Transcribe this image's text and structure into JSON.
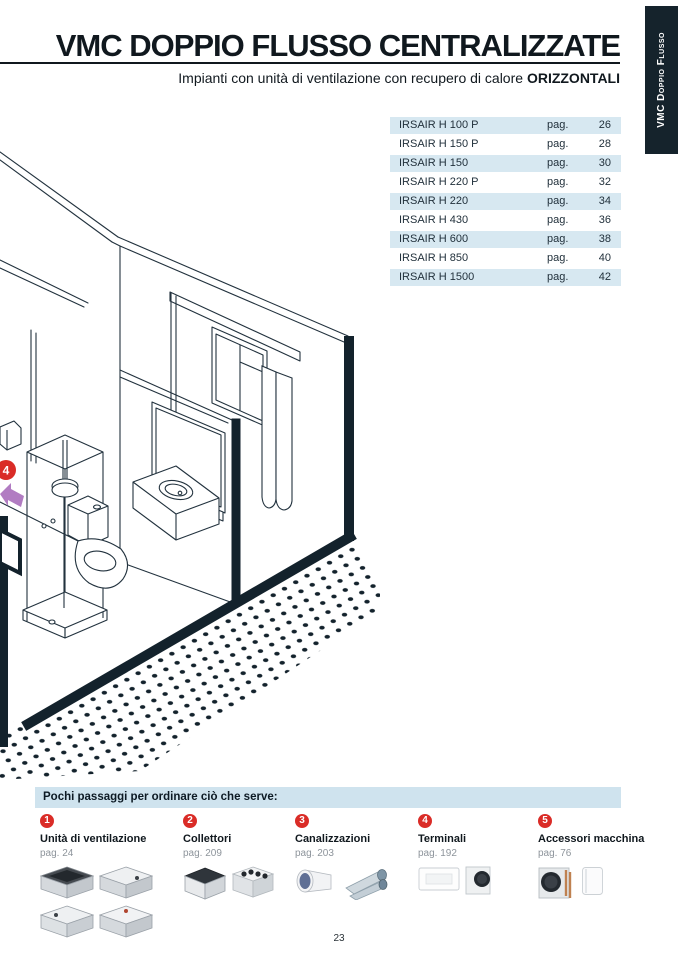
{
  "header": {
    "title": "VMC DOPPIO FLUSSO CENTRALIZZATE",
    "subtitle_prefix": "Impianti con unità di ventilazione con recupero di calore ",
    "subtitle_bold": "ORIZZONTALI",
    "side_tab_label": "VMC Doppio Flusso"
  },
  "products_table": {
    "pag_label": "pag.",
    "rows": [
      {
        "name": "IRSAIR H 100 P",
        "page": "26"
      },
      {
        "name": "IRSAIR H 150 P",
        "page": "28"
      },
      {
        "name": "IRSAIR H 150",
        "page": "30"
      },
      {
        "name": "IRSAIR H 220 P",
        "page": "32"
      },
      {
        "name": "IRSAIR H 220",
        "page": "34"
      },
      {
        "name": "IRSAIR H 430",
        "page": "36"
      },
      {
        "name": "IRSAIR H 600",
        "page": "38"
      },
      {
        "name": "IRSAIR H 850",
        "page": "40"
      },
      {
        "name": "IRSAIR H 1500",
        "page": "42"
      }
    ]
  },
  "diagram": {
    "callout_number": "4"
  },
  "steps": {
    "heading": "Pochi passaggi  per ordinare ciò che serve:",
    "items": [
      {
        "num": "1",
        "title": "Unità di ventilazione",
        "page_ref": "pag. 24"
      },
      {
        "num": "2",
        "title": "Collettori",
        "page_ref": "pag. 209"
      },
      {
        "num": "3",
        "title": "Canalizzazioni",
        "page_ref": "pag. 203"
      },
      {
        "num": "4",
        "title": "Terminali",
        "page_ref": "pag. 192"
      },
      {
        "num": "5",
        "title": "Accessori macchina",
        "page_ref": "pag. 76"
      }
    ]
  },
  "footer": {
    "page_number": "23"
  },
  "colors": {
    "row_blue": "#d7e8f1",
    "banner_blue": "#cfe3ee",
    "dark_navy": "#15232c",
    "line_dark": "#22323e",
    "badge_red": "#da2c27",
    "arrow_purple": "#b17cc2",
    "muted_text": "#8d949b"
  }
}
